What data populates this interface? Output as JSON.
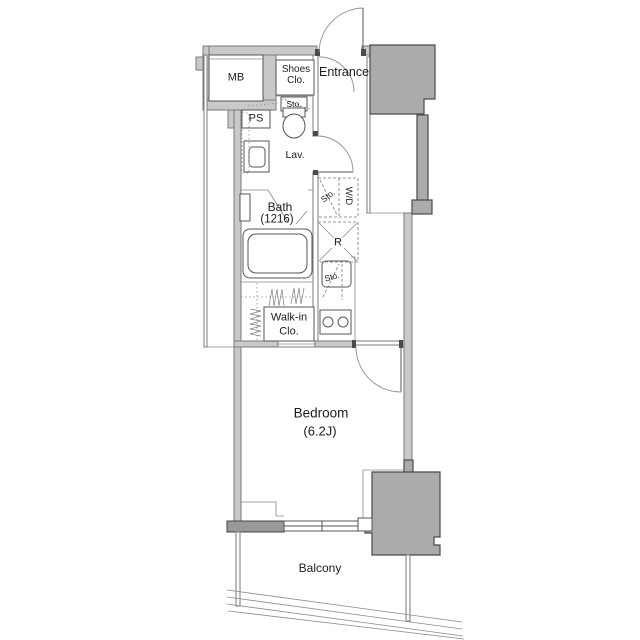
{
  "floorplan": {
    "labels": {
      "meter_box": "MB",
      "shoes_closet": [
        "Shoes",
        "Clo."
      ],
      "entrance": "Entrance",
      "pipe_space": "PS",
      "storage_above_toilet": "Sto.",
      "lavatory": "Lav.",
      "bath": [
        "Bath",
        "(1216)"
      ],
      "storage_laundry": "Sto.",
      "washer_dryer": "W/D",
      "refrigerator": "R",
      "storage_kitchen": "Sto.",
      "walk_in_closet": [
        "Walk-in",
        "Clo."
      ],
      "bedroom": [
        "Bedroom",
        "(6.2J)"
      ],
      "balcony": "Balcony"
    },
    "colors": {
      "background": "#ffffff",
      "wall_fill": "#c9c9c9",
      "wall_line": "#7a7a7a",
      "pillar_fill": "#ababab",
      "pillar_line": "#4a4a4a",
      "window_wall_fill": "#999999",
      "text": "#1c1c1c"
    }
  }
}
